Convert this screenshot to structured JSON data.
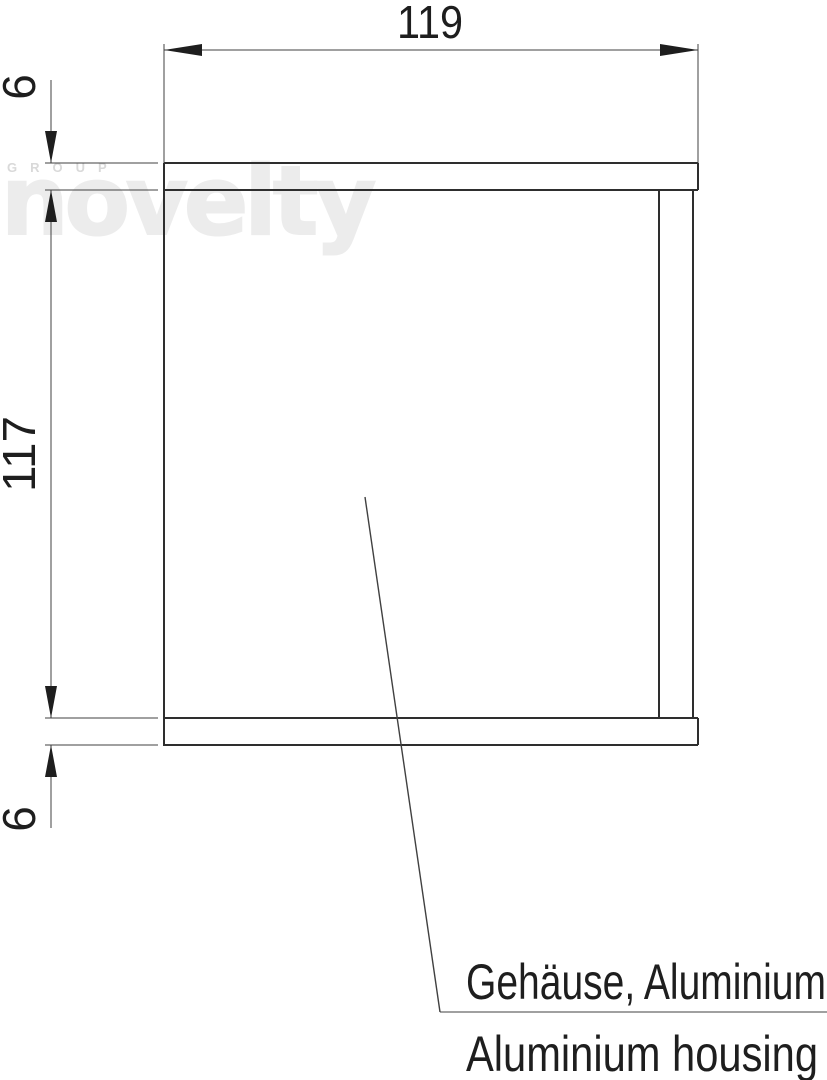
{
  "drawing": {
    "type": "technical-section-drawing",
    "dimensions": {
      "width": "119",
      "top_plate_thickness": "6",
      "inner_height": "117",
      "bottom_plate_thickness": "6"
    },
    "labels": {
      "part_name_de": "Gehäuse, Aluminium",
      "part_name_en": "Aluminium housing"
    },
    "watermark": {
      "group": "GROUP",
      "brand": "novelty"
    },
    "colors": {
      "object_line": "#2e2e2e",
      "thin_line": "#404040",
      "text": "#1e1e1e",
      "watermark_brand": "#ececec",
      "watermark_group": "#d9d9d9",
      "background": "#ffffff"
    }
  }
}
